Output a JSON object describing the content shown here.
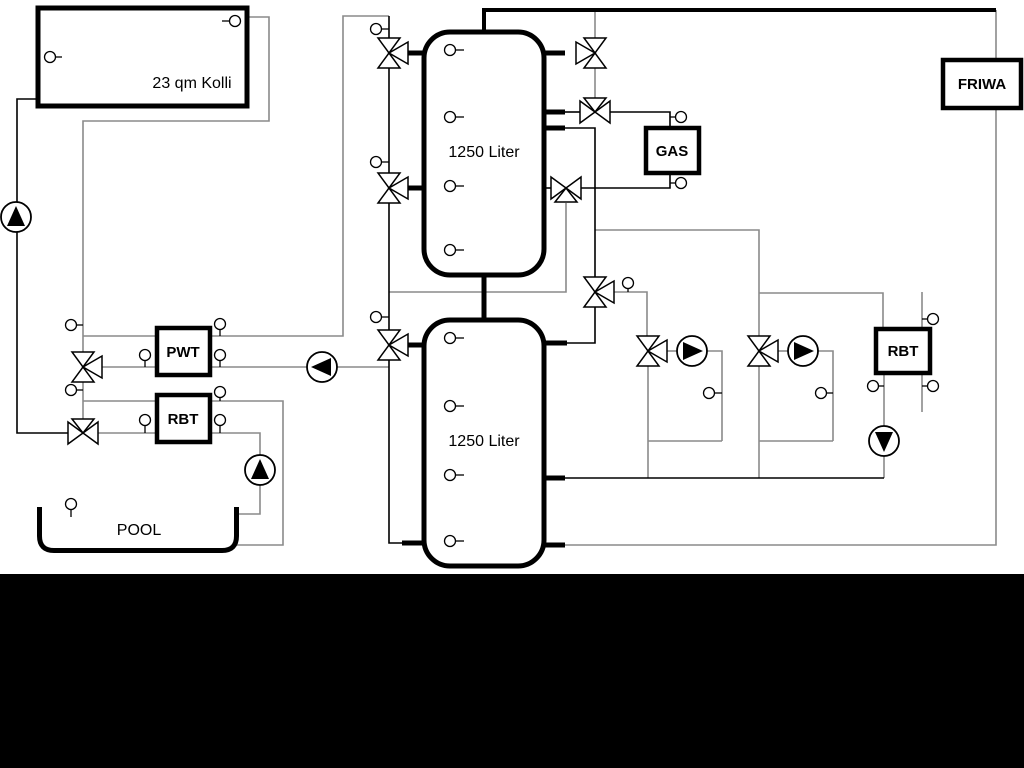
{
  "diagram": {
    "title": "heating-system-schematic",
    "labels": {
      "collector": "23 qm Kolli",
      "tank1": "1250 Liter",
      "tank2": "1250 Liter",
      "gas": "GAS",
      "friwa": "FRIWA",
      "pwt": "PWT",
      "rbt_left": "RBT",
      "rbt_right": "RBT",
      "pool": "POOL"
    },
    "colors": {
      "line_primary": "#000000",
      "line_secondary": "#8a8a8a",
      "background": "#ffffff",
      "bottom_mask": "#000000"
    }
  }
}
